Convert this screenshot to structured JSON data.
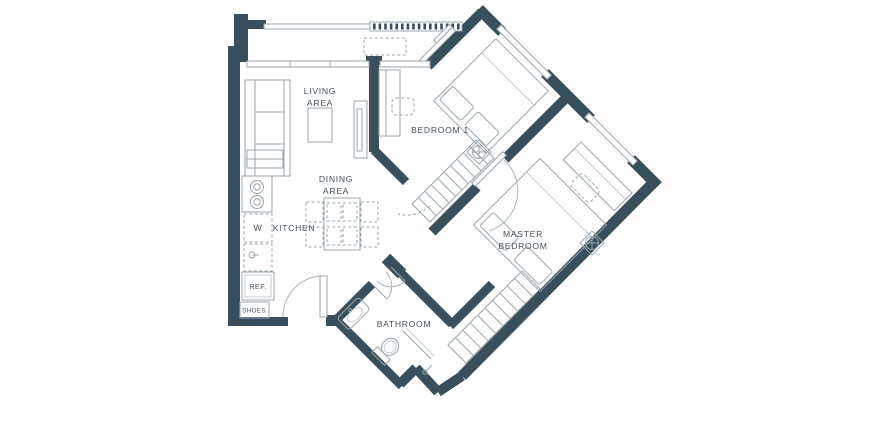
{
  "plan": {
    "type": "apartment-floor-plan",
    "colors": {
      "wall": "#3a4f5c",
      "furniture_line": "#9aa6ad",
      "text": "#47525a",
      "background": "#ffffff"
    },
    "labels": {
      "living_area_line1": "LIVING",
      "living_area_line2": "AREA",
      "dining_area_line1": "DINING",
      "dining_area_line2": "AREA",
      "kitchen": "KITCHEN",
      "washer": "W",
      "refrigerator": "REF.",
      "shoes": "SHOES",
      "bedroom1": "BEDROOM 1",
      "master_line1": "MASTER",
      "master_line2": "BEDROOM",
      "bathroom": "BATHROOM"
    },
    "rooms": [
      {
        "name": "balcony",
        "symbols": [
          "railing",
          "louvre-ledge",
          "ac-unit-dashed",
          "sliding-door"
        ]
      },
      {
        "name": "living-area",
        "symbols": [
          "sofa",
          "coffee-table",
          "tv-console",
          "window"
        ]
      },
      {
        "name": "dining-area",
        "symbols": [
          "dining-table",
          "four-chairs"
        ]
      },
      {
        "name": "kitchen",
        "symbols": [
          "counter",
          "stove-two-burners",
          "washer",
          "sink",
          "refrigerator",
          "shoe-cabinet"
        ]
      },
      {
        "name": "bedroom-1",
        "symbols": [
          "double-bed",
          "pillows",
          "desk",
          "chair",
          "wardrobe-hanging",
          "fan",
          "window",
          "door-swing"
        ]
      },
      {
        "name": "master-bedroom",
        "symbols": [
          "double-bed",
          "pillows",
          "desk",
          "chair",
          "wardrobe-hanging",
          "fan",
          "window",
          "sliding-door",
          "door-swing"
        ]
      },
      {
        "name": "bathroom",
        "symbols": [
          "basin",
          "toilet",
          "shower-screen",
          "bifold-door"
        ]
      },
      {
        "name": "entry",
        "symbols": [
          "door-swing"
        ]
      }
    ]
  }
}
